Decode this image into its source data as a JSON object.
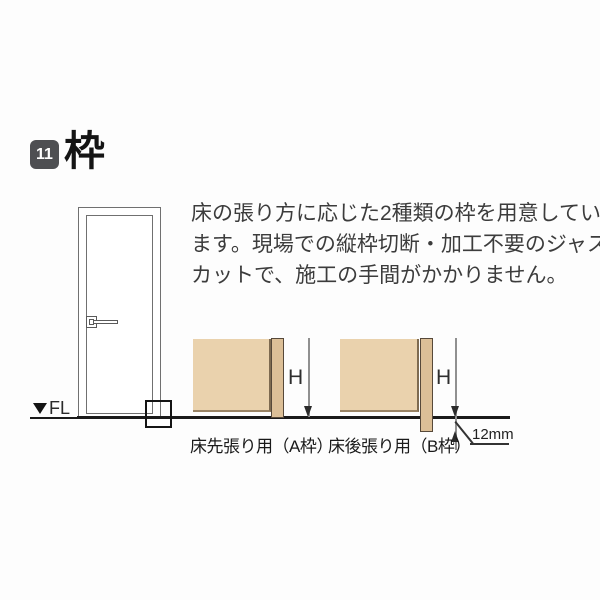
{
  "section": {
    "number": "11",
    "title": "枠"
  },
  "description": {
    "lines": [
      "床の張り方に応じた2種類の枠を用意してい",
      "ます。現場での縦枠切断・加工不要のジャスト",
      "カットで、施工の手間がかかりません。"
    ]
  },
  "door_figure": {
    "floor_level_label": "FL"
  },
  "diagrams": {
    "a": {
      "caption": "床先張り用（A枠）",
      "height_label": "H"
    },
    "b": {
      "caption": "床後張り用（B枠）",
      "height_label": "H",
      "offset_label": "12mm"
    }
  },
  "colors": {
    "badge_bg": "#4e4f52",
    "badge_text": "#ffffff",
    "title_text": "#141414",
    "body_text": "#3c3c3c",
    "wall_fill": "#ead2ad",
    "frame_strip_fill": "#dcbf97",
    "strip_border": "#57493a",
    "floor_line": "#1a1a1a",
    "dimension_line": "#909090",
    "door_line": "#707070"
  }
}
